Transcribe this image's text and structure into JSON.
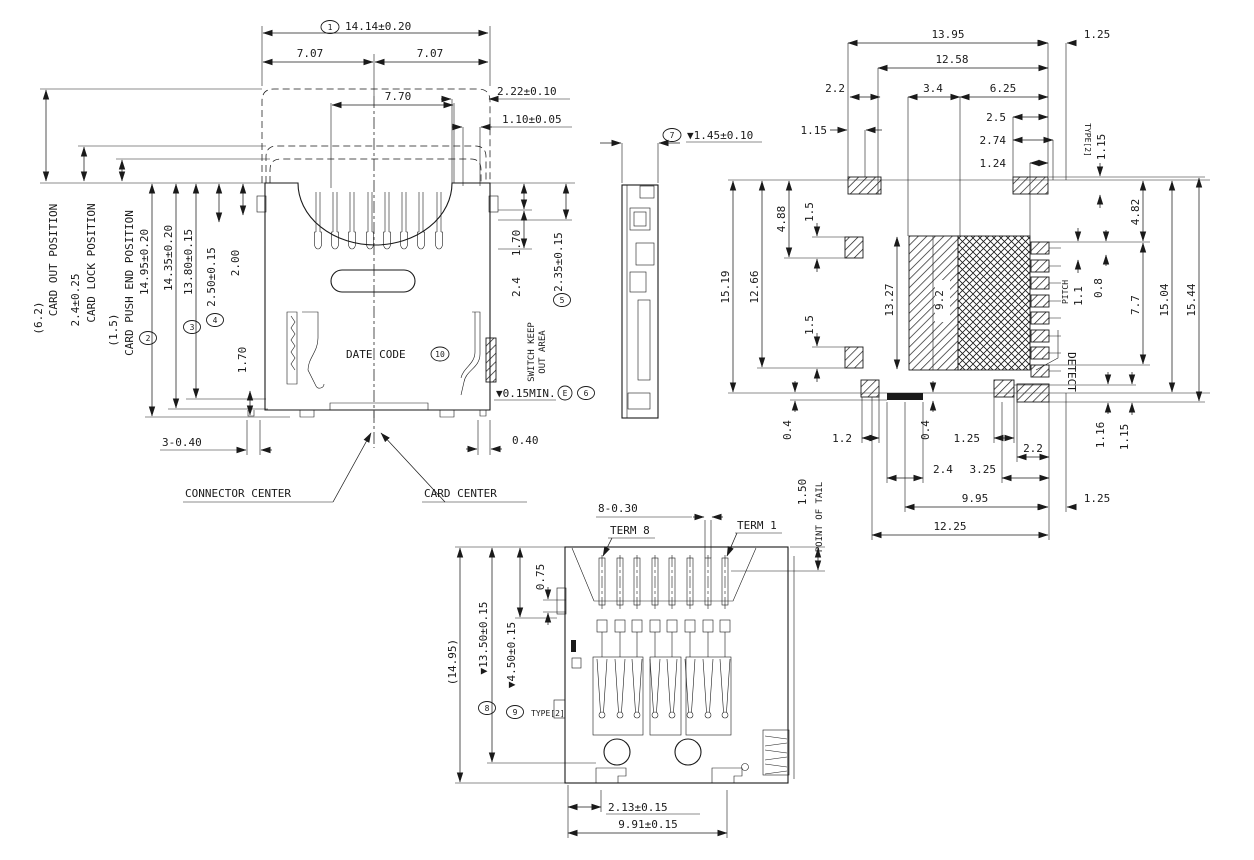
{
  "front": {
    "c1": "1",
    "w_total": "14.14±0.20",
    "w_left": "7.07",
    "w_right": "7.07",
    "w_inner": "7.70",
    "d222": "2.22±0.10",
    "d110": "1.10±0.05",
    "card_out_v": "(6.2)",
    "card_out": "CARD OUT POSITION",
    "card_lock_v": "2.4±0.25",
    "card_lock": "CARD LOCK POSITION",
    "card_push_v": "(1.5)",
    "card_push": "CARD PUSH END POSITION",
    "c2": "2",
    "h1495": "14.95±0.20",
    "h1435": "14.35±0.20",
    "c3": "3",
    "h1380": "13.80±0.15",
    "c4": "4",
    "d250": "2.50±0.15",
    "d200": "2.00",
    "d170l": "1.70",
    "d170r": "1.70",
    "d24": "2.4",
    "skoa1": "SWITCH KEEP",
    "skoa2": "OUT AREA",
    "c5": "5",
    "d235": "2.35±0.15",
    "date_code": "DATE CODE",
    "c10": "10",
    "flat": "▼0.15MIN.",
    "datum_e": "E",
    "c6": "6",
    "d3040": "3-0.40",
    "d040": "0.40",
    "conn_center": "CONNECTOR CENTER",
    "card_center": "CARD CENTER"
  },
  "side": {
    "c7": "7",
    "d145": "▼1.45±0.10"
  },
  "footprint": {
    "d1395": "13.95",
    "d1258": "12.58",
    "d22t": "2.2",
    "d34": "3.4",
    "d625": "6.25",
    "d115tl": "1.15",
    "d25": "2.5",
    "d274": "2.74",
    "d124": "1.24",
    "d125t": "1.25",
    "type2": "TYPE[2]",
    "d115r": "1.15",
    "d1519": "15.19",
    "d1266": "12.66",
    "d488": "4.88",
    "d15u": "1.5",
    "d15l": "1.5",
    "d1327": "13.27",
    "d92": "9.2",
    "d482": "4.82",
    "d08": "0.8",
    "d11": "1.1",
    "pitch": "PITCH",
    "detect": "DETECT",
    "d77": "7.7",
    "d1504": "15.04",
    "d1544": "15.44",
    "d116": "1.16",
    "d115br": "1.15",
    "d04l": "0.4",
    "d12": "1.2",
    "d125m": "1.25",
    "d04m": "0.4",
    "d22b": "2.2",
    "d24": "2.4",
    "d325": "3.25",
    "d995": "9.95",
    "d125b": "1.25",
    "d1225": "12.25"
  },
  "bottom": {
    "d8030": "8-0.30",
    "term8": "TERM 8",
    "term1": "TERM 1",
    "d150": "1.50",
    "pot": "POINT OF TAIL",
    "d1495": "(14.95)",
    "c8": "8",
    "d1350": "▼13.50±0.15",
    "c9": "9",
    "d450": "▼4.50±0.15",
    "type2": "TYPE[2]",
    "d075": "0.75",
    "d213": "2.13±0.15",
    "d991": "9.91±0.15"
  }
}
